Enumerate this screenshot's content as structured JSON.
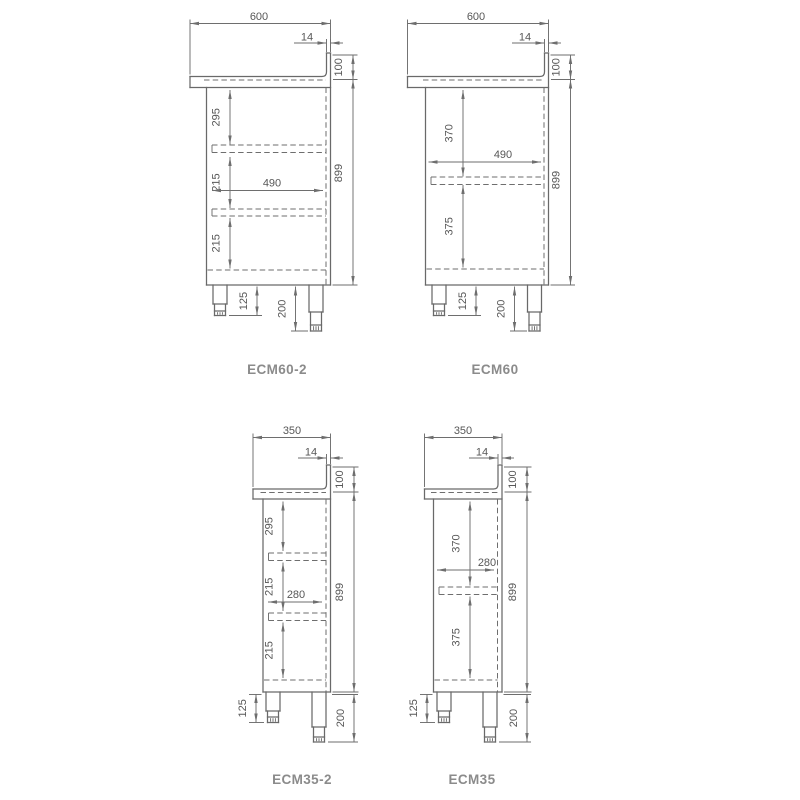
{
  "page": {
    "background": "#ffffff"
  },
  "style": {
    "outline_color": "#696969",
    "dim_line_color": "#6e6e6e",
    "dim_text_color": "#575757",
    "label_color": "#8b8b8b"
  },
  "cabinets": [
    {
      "label": "ECM60-2",
      "dims": {
        "width": "600",
        "splash_thickness": "14",
        "splash_height": "100",
        "height": "899",
        "inner_width": "490",
        "verticals": [
          "295",
          "215",
          "215"
        ],
        "leg_adjust": "125",
        "leg_height": "200"
      }
    },
    {
      "label": "ECM60",
      "dims": {
        "width": "600",
        "splash_thickness": "14",
        "splash_height": "100",
        "height": "899",
        "inner_width": "490",
        "verticals": [
          "370",
          "375"
        ],
        "leg_adjust": "125",
        "leg_height": "200"
      }
    },
    {
      "label": "ECM35-2",
      "dims": {
        "width": "350",
        "splash_thickness": "14",
        "splash_height": "100",
        "height": "899",
        "inner_width": "280",
        "verticals": [
          "295",
          "215",
          "215"
        ],
        "leg_adjust": "125",
        "leg_height": "200"
      }
    },
    {
      "label": "ECM35",
      "dims": {
        "width": "350",
        "splash_thickness": "14",
        "splash_height": "100",
        "height": "899",
        "inner_width": "280",
        "verticals": [
          "370",
          "375"
        ],
        "leg_adjust": "125",
        "leg_height": "200"
      }
    }
  ]
}
